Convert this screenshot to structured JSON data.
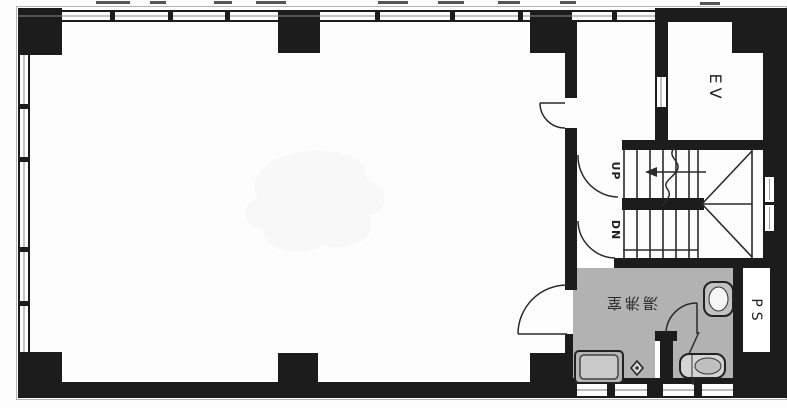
{
  "title": "building-floor-plan",
  "labels": {
    "elevator": "EV",
    "stairs_up": "UP",
    "stairs_down": "DN",
    "pipe_shaft": "PS",
    "kitchenette": "湯沸室"
  },
  "colors": {
    "wall": "#1c1c1c",
    "floor": "#ffffff",
    "wet": "#b2b2b2",
    "line": "#2a2a2a"
  }
}
